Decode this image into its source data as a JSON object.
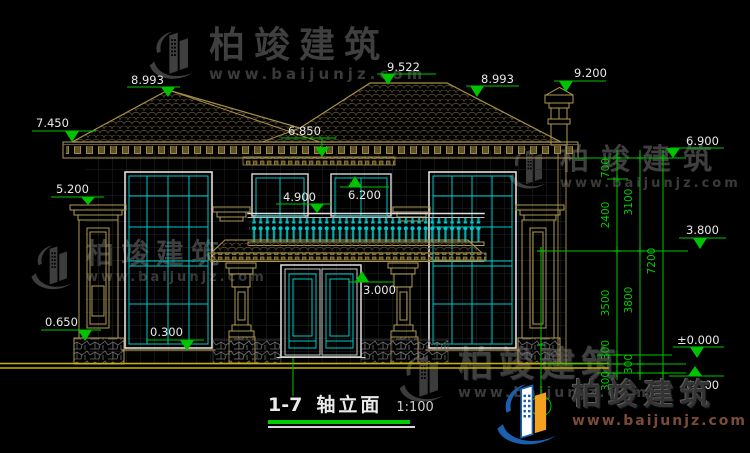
{
  "drawing": {
    "title_axis": "1-7",
    "title_name": "轴立面",
    "scale": "1:100"
  },
  "levels": {
    "ridge_main": "9.522",
    "ridge_left": "8.993",
    "ridge_right": "8.993",
    "chimney_top": "9.200",
    "eave_left": "7.450",
    "eave_center": "6.850",
    "eave_right": "6.900",
    "pillar_left_cap": "5.200",
    "window2_top": "6.200",
    "balcony_rail": "4.900",
    "level_3800": "3.800",
    "door_top": "3.000",
    "base_left": "0.650",
    "floor1": "0.300",
    "ground_zero": "±0.000",
    "ground_minus": "-0.300"
  },
  "dims": {
    "a1": "700",
    "a2": "2400",
    "a3": "3500",
    "a4": "300",
    "a5": "300",
    "b1": "3100",
    "b2": "3800",
    "b3": "300",
    "c1": "7200"
  },
  "watermark": {
    "brand": "柏竣建筑",
    "url": "www.baijunjz.com"
  },
  "colors": {
    "dimension_green": "#00c300",
    "frame_cyan": "#00c9c9",
    "trim_tan": "#b09a52",
    "ground_yellow": "#c8b400",
    "text_white": "#e8e8e8",
    "logo_blue": "#1b5fae",
    "logo_orange": "#f2a21e"
  }
}
